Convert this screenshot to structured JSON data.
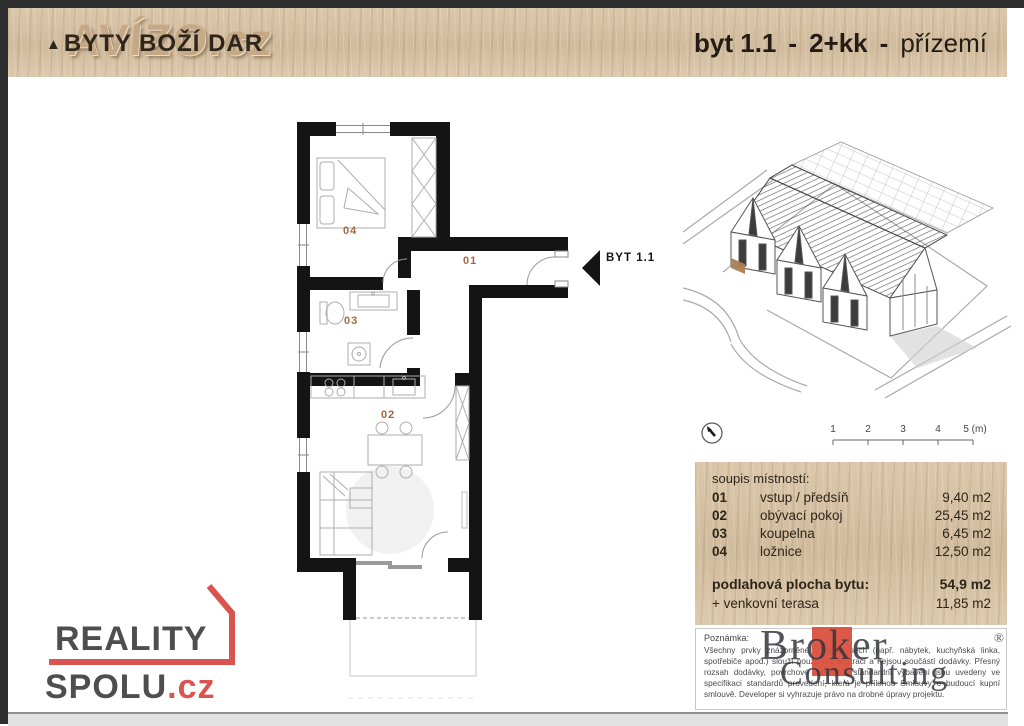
{
  "header": {
    "watermark": "AVÍZO.cz",
    "triangle": "▲",
    "project_title": "BYTY BOŽÍ DAR",
    "unit_id": "byt 1.1",
    "separator": "-",
    "unit_layout": "2+kk",
    "unit_floor": "přízemí"
  },
  "floor_plan": {
    "entrance_label": "BYT 1.1",
    "room_labels": {
      "r01": "01",
      "r02": "02",
      "r03": "03",
      "r04": "04"
    },
    "label_color": "#a5673f"
  },
  "site": {
    "scale_ticks": [
      "1",
      "2",
      "3",
      "4",
      "5 (m)"
    ]
  },
  "room_table": {
    "title": "soupis místností:",
    "rows": [
      {
        "code": "01",
        "name": "vstup / předsíň",
        "area": "9,40 m2"
      },
      {
        "code": "02",
        "name": "obývací pokoj",
        "area": "25,45 m2"
      },
      {
        "code": "03",
        "name": "koupelna",
        "area": "6,45 m2"
      },
      {
        "code": "04",
        "name": "ložnice",
        "area": "12,50 m2"
      }
    ],
    "total_label": "podlahová plocha bytu:",
    "total_area": "54,9 m2",
    "terrace_label": "+ venkovní terasa",
    "terrace_area": "11,85 m2"
  },
  "note": {
    "title": "Poznámka:",
    "text": "Všechny prvky znázorněné v půdorysech (např. nábytek, kuchyňská linka, spotřebiče apod.) slouží pouze pro ilustraci a nejsou součástí dodávky. Přesný rozsah dodávky, povrchové úpravy a standardní vybavení jsou uvedeny ve specifikaci standardů provedení, která je přílohou Smlouvy o budoucí kupní smlouvě. Developer si vyhrazuje právo na drobné úpravy projektu."
  },
  "logos": {
    "reality_spolu": {
      "line1": "REALITY",
      "line2": "SPOLU",
      "tld": ".cz"
    },
    "broker": {
      "word1": "Broker",
      "word2": "Consulting",
      "registered": "®"
    }
  },
  "colors": {
    "accent_red": "#d9534f",
    "broker_red": "#d9503c",
    "wood": "#d7c1a5",
    "wall": "#141414"
  }
}
